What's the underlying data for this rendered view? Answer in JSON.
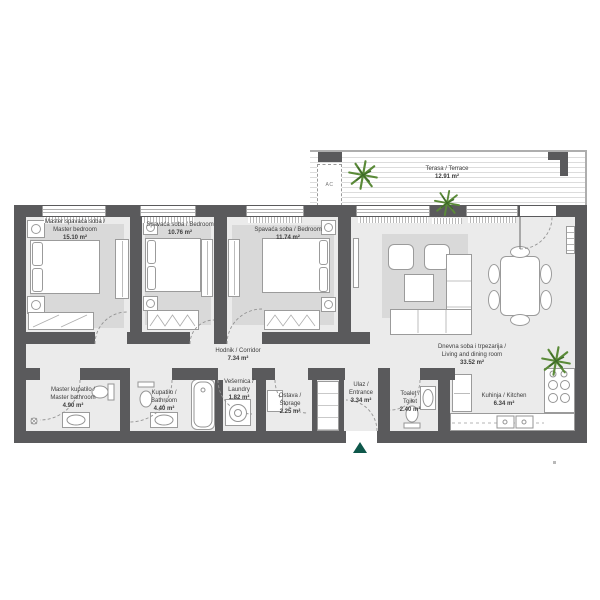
{
  "plan": {
    "rooms": {
      "master_bedroom": {
        "line1": "Master spavaća soba /",
        "line2": "Master bedroom",
        "area": "15.10 m²"
      },
      "bedroom2": {
        "line1": "Spavaća soba / Bedroom",
        "area": "10.76 m²"
      },
      "bedroom3": {
        "line1": "Spavaća soba / Bedroom",
        "area": "11.74 m²"
      },
      "terrace": {
        "line1": "Terasa / Terrace",
        "area": "12.91 m²"
      },
      "living_room": {
        "line1": "Dnevna soba i trpezarija /",
        "line2": "Living and dining room",
        "area": "33.52 m²"
      },
      "corridor": {
        "line1": "Hodnik / Corridor",
        "area": "7.34 m²"
      },
      "master_bathroom": {
        "line1": "Master kupatilo /",
        "line2": "Master bathroom",
        "area": "4.90 m²"
      },
      "bathroom": {
        "line1": "Kupatilo /",
        "line2": "Bathroom",
        "area": "4.40 m²"
      },
      "laundry": {
        "line1": "Vešernica /",
        "line2": "Laundry",
        "area": "1.82 m²"
      },
      "storage": {
        "line1": "Ostava /",
        "line2": "Storage",
        "area": "2.25 m²"
      },
      "entrance": {
        "line1": "Ulaz /",
        "line2": "Entrance",
        "area": "3.34 m²"
      },
      "toilet": {
        "line1": "Toalet /",
        "line2": "Toilet",
        "area": "2.40 m²"
      },
      "kitchen": {
        "line1": "Kuhinja / Kitchen",
        "area": "6.34 m²"
      }
    },
    "annotations": {
      "ac_unit": "AC"
    },
    "colors": {
      "wall": "#5a5a5c",
      "floor": "#ebebeb",
      "rug": "#d9d9d9",
      "plant_green": "#5a8a38",
      "entrance_marker": "#0e574a"
    }
  }
}
